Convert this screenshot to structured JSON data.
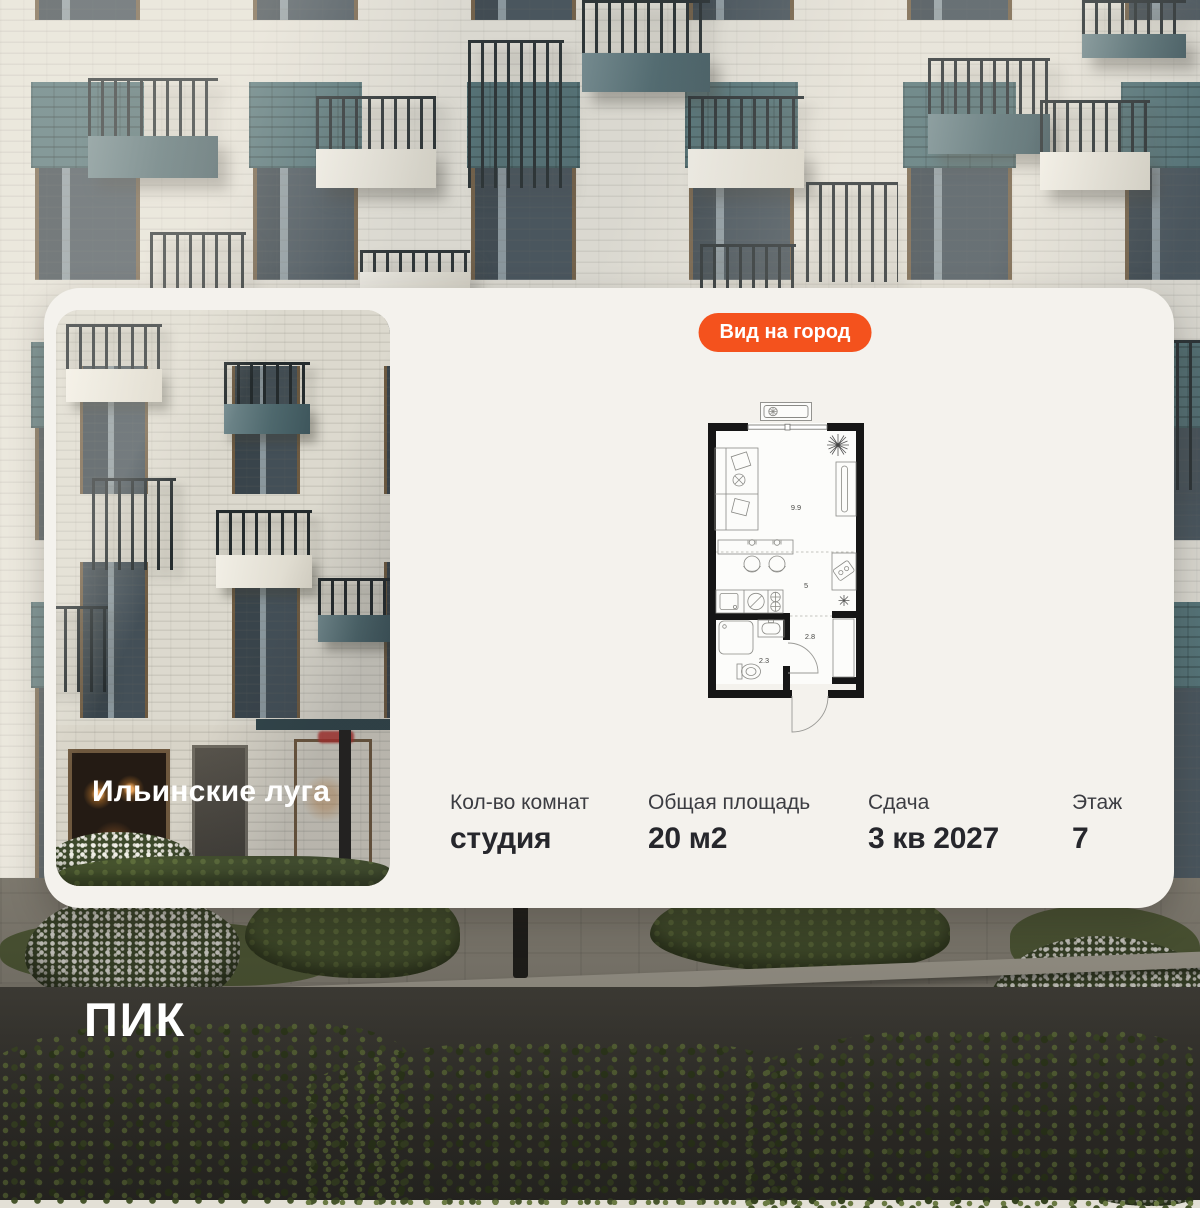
{
  "card": {
    "view_badge": "Вид на город",
    "project_name": "Ильинские луга",
    "floorplan": {
      "living_area": "9.9",
      "kitchen_area": "5",
      "hallway_area": "2.8",
      "bathroom_area": "2.3"
    },
    "stats": [
      {
        "label": "Кол-во комнат",
        "value": "студия"
      },
      {
        "label": "Общая площадь",
        "value": "20 м2"
      },
      {
        "label": "Сдача",
        "value": "3 кв 2027"
      },
      {
        "label": "Этаж",
        "value": "7"
      }
    ]
  },
  "brand": {
    "logo": "ПИК"
  },
  "colors": {
    "accent": "#F4521D",
    "card_bg": "#F4F2ED",
    "plan_wall": "#161616",
    "balcony_teal": "#4E686D",
    "balcony_white": "#F2EFE6"
  }
}
